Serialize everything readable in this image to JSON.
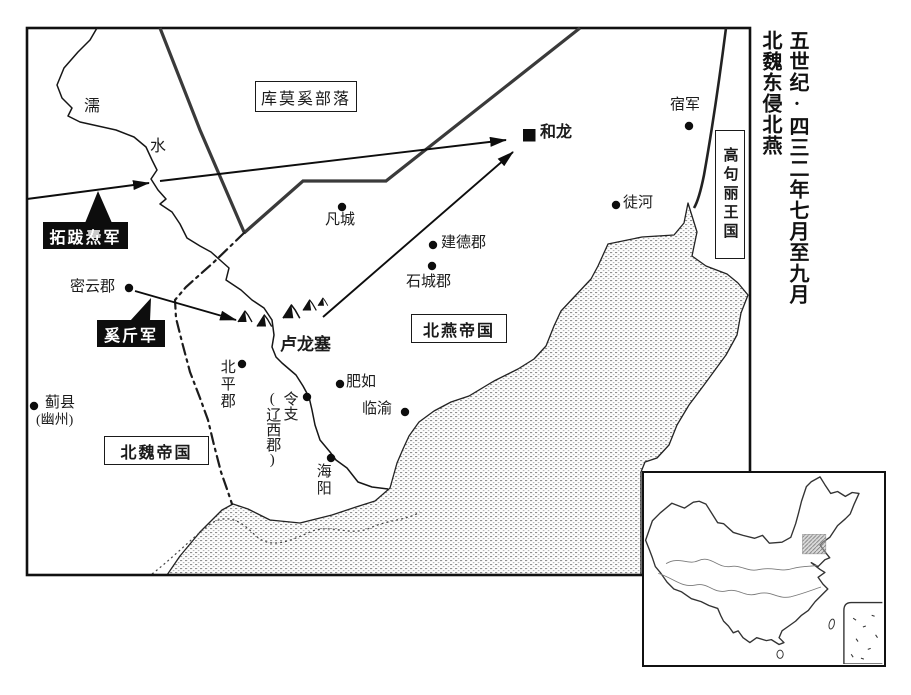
{
  "title": {
    "line1": "五世纪·四三二年七月至九月",
    "line2": "北魏东侵北燕"
  },
  "regions": {
    "kumoxi": "库莫奚部落",
    "beiyan": "北燕帝国",
    "beiwei": "北魏帝国",
    "gaogouli": "高句丽王国"
  },
  "armies": {
    "tuoba": "拓跋焘军",
    "xijin": "奚斤军"
  },
  "river": {
    "char1": "濡",
    "char2": "水"
  },
  "places": {
    "helong": "和龙",
    "sujun": "宿军",
    "tuhe": "徒河",
    "fancheng": "凡城",
    "jiande": "建德郡",
    "shicheng": "石城郡",
    "miyun": "密云郡",
    "lulong": "卢龙塞",
    "beiping": "北平郡",
    "lingzhi": "令支",
    "liaoxi": "(辽西郡)",
    "feiru": "肥如",
    "linyu": "临渝",
    "haiyang": "海阳",
    "jixian": "蓟县",
    "youzhou": "(幽州)"
  },
  "colors": {
    "ink": "#1a1a1a",
    "border_gray": "#3a3a3a",
    "sea_stipple": "#909090",
    "army_box_bg": "#0d0d0d",
    "army_box_text": "#ffffff"
  }
}
